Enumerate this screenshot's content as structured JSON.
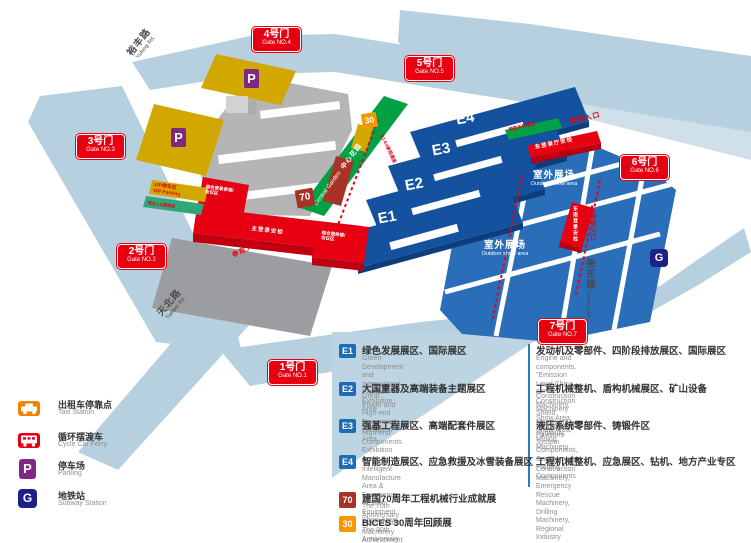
{
  "map": {
    "gates": [
      {
        "name": "1号门",
        "en": "Gate NO.1"
      },
      {
        "name": "2号门",
        "en": "Gate NO.2"
      },
      {
        "name": "3号门",
        "en": "Gate NO.3"
      },
      {
        "name": "4号门",
        "en": "Gate NO.4"
      },
      {
        "name": "5号门",
        "en": "Gate NO.5"
      },
      {
        "name": "6号门",
        "en": "Gate NO.6"
      },
      {
        "name": "7号门",
        "en": "Gate NO.7"
      }
    ],
    "halls": {
      "e1": "E1",
      "e2": "E2",
      "e3": "E3",
      "e4": "E4"
    },
    "outdoor": {
      "cn": "室外展场",
      "en": "Outdoor show area"
    },
    "garden": {
      "en": "Central Garden",
      "cn": "中心花园"
    },
    "roads": {
      "yufeng": {
        "cn": "裕丰路",
        "en": "Yufeng Rd."
      },
      "tianbei": {
        "cn": "天北路",
        "en": "Tianbei Rd."
      },
      "yudong": {
        "cn": "裕东路",
        "en": "Yudong Rd."
      }
    },
    "badges": {
      "b70": "70",
      "b30": "30",
      "parking": "P",
      "subway": "G"
    },
    "labels": {
      "entrance": "参观入口",
      "vip": "VIP停车区\nVIP Parking",
      "visitor_service": "观众入口服务区",
      "bridge": "地铁天桥通道",
      "check_east": "东登录厅安检",
      "check_southeast": "东南登录安检",
      "main_check": "主登录安检",
      "left_wing": "综合登录参观/\n会议区",
      "right_wing": "综合服务楼/\n会议区",
      "corridor": "E1-E4参观通道"
    }
  },
  "legend_left": [
    {
      "cn": "出租车停靠点",
      "en": "Taxi Station"
    },
    {
      "cn": "循环摆渡车",
      "en": "Cycle Car Ferry"
    },
    {
      "cn": "停车场",
      "en": "Parking"
    },
    {
      "cn": "地铁站",
      "en": "Subway Station"
    }
  ],
  "legend_rows": [
    {
      "badge": "E1",
      "cn_left": "绿色发展展区、国际展区",
      "en_left": "Green Development and International\nPavilion Exhibition Area",
      "cn_right": "发动机及零部件、四阶段排放展区、国际展区",
      "en_right": "Engine and components, \"Emission Level China IV\"\nConstruction Machinery Show Area, International Pavilions"
    },
    {
      "badge": "E2",
      "cn_left": "大国重器及高端装备主题展区",
      "en_left": "Great Power and High-end Equipment\nExhibition Area",
      "cn_right": "工程机械整机、盾构机械展区、矿山设备",
      "en_right": "Construction Machinery, Shield Machinery Show Area,\nMining Machinery"
    },
    {
      "badge": "E3",
      "cn_left": "强基工程展区、高端配套件展区",
      "en_left": "High-end Components Exhibition Area",
      "cn_right": "液压系统零部件、铸锻件区",
      "en_right": "Hydraulic System Components, Casting and Forging\nComponents"
    },
    {
      "badge": "E4",
      "cn_left": "智能制造展区、应急救援及冰雪装备展区",
      "en_left": "Intelligent Manufacture Area & Emergency\nRescue Equipment Show Area",
      "cn_right": "工程机械整机、应急展区、钻机、地方产业专区",
      "en_right": "Construction Machinery, Emergency Rescue Machinery,\nDrilling Machinery, Regional Industry Show Area"
    },
    {
      "badge": "70",
      "cn_left": "建国70周年工程机械行业成就展",
      "en_left": "The 70th Anniversary Construction Machinery Achievement Exhibition",
      "cn_right": "",
      "en_right": ""
    },
    {
      "badge": "30",
      "cn_left": "BICES 30周年回顾展",
      "en_left": "The 30th Anniversary of BICES Review Exhibition",
      "cn_right": "",
      "en_right": ""
    }
  ]
}
